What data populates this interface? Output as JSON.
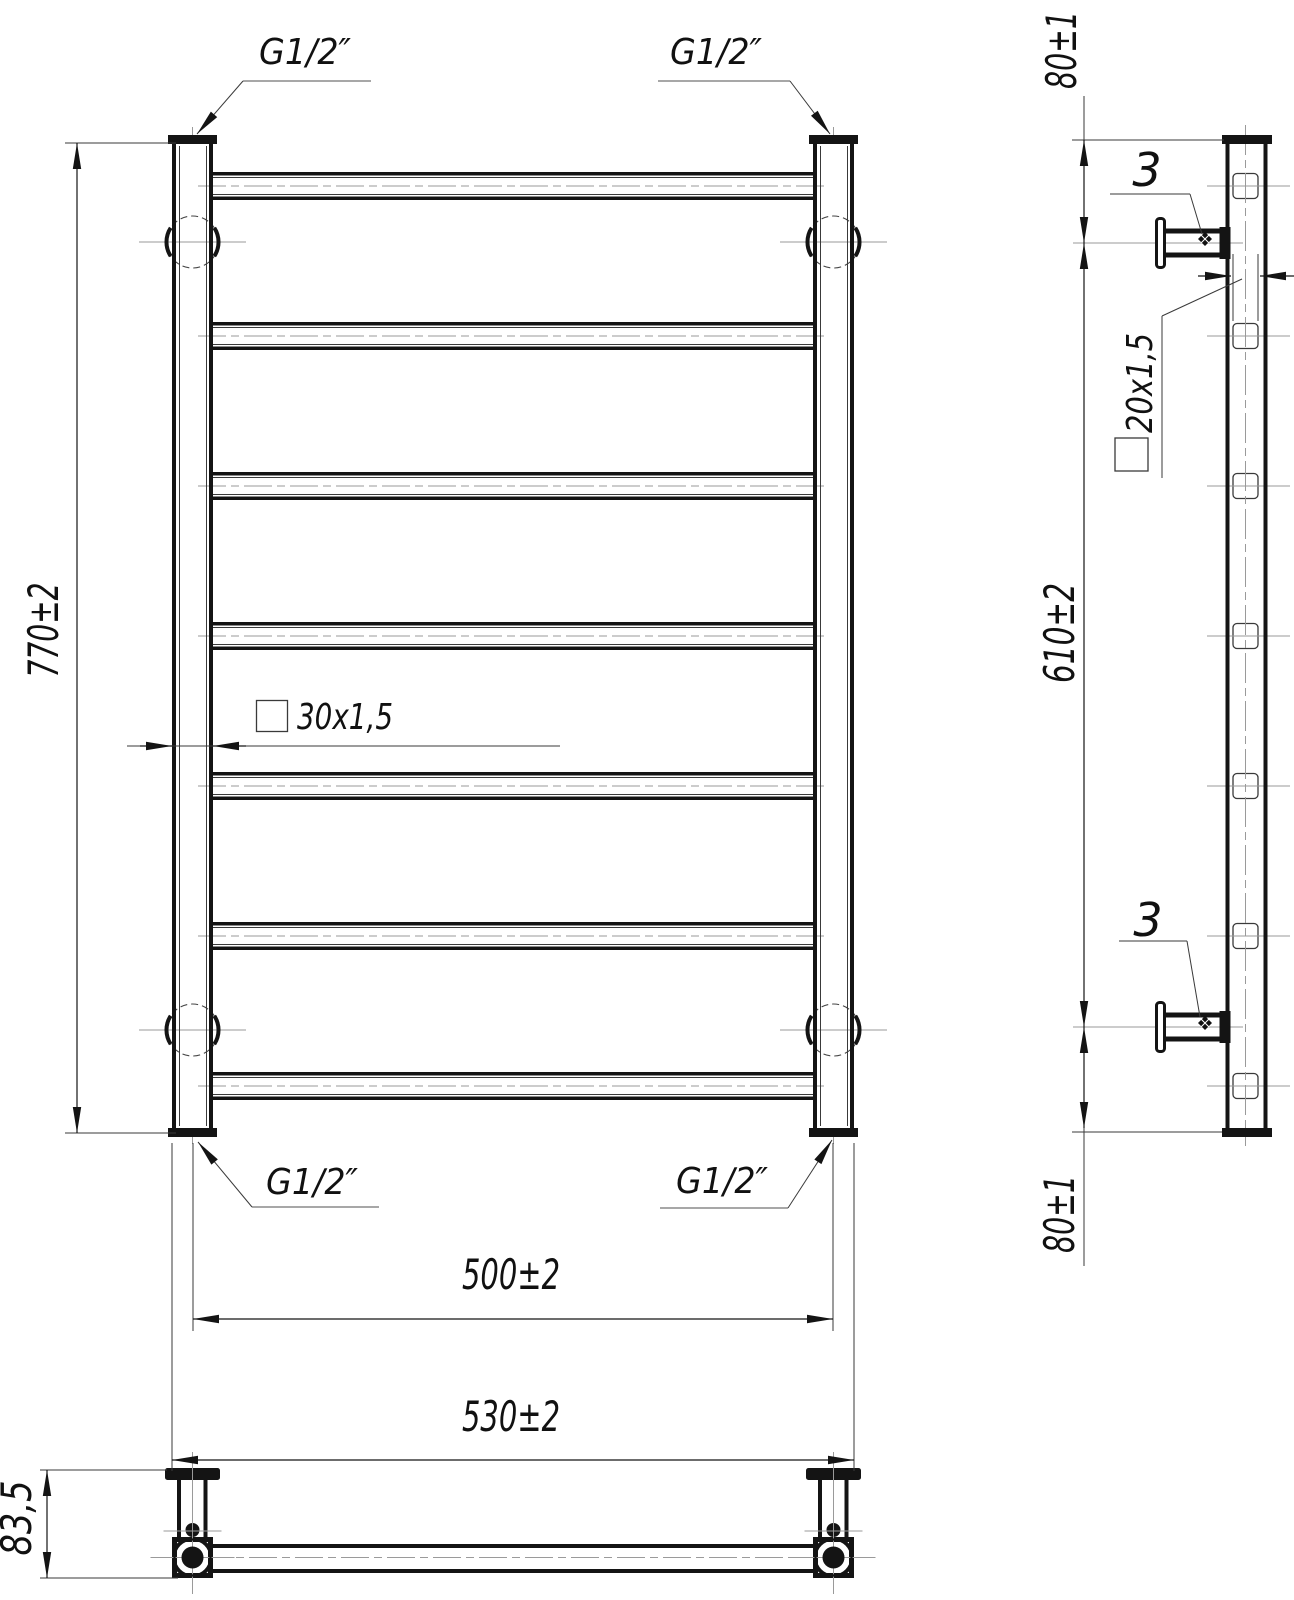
{
  "drawing": {
    "title_hint": "towel-rail-technical-drawing",
    "labels": {
      "thread": "G1/2″",
      "height": "770±2",
      "axis_width": "500±2",
      "overall_width": "530±2",
      "post_profile": "30x1,5",
      "rung_profile": "20x1,5",
      "wall_offset_top": "80±1",
      "bracket_distance": "610±2",
      "wall_offset_bottom": "80±1",
      "screw_size": "3",
      "depth": "83,5"
    },
    "colors": {
      "line_main": "#141414",
      "line_thin": "#3a3a3a",
      "centerline": "#9a9a9a",
      "background": "#ffffff"
    },
    "views": [
      "front",
      "side",
      "bottom"
    ],
    "rung_count": 7
  }
}
